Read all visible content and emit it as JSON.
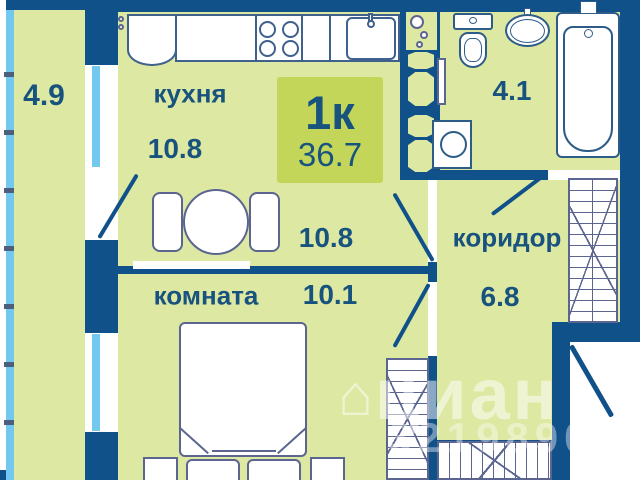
{
  "plan": {
    "badge": {
      "rooms": "1к",
      "total_area": "36.7"
    },
    "rooms": {
      "balcony": {
        "area": "4.9"
      },
      "kitchen": {
        "name": "кухня",
        "area": "10.8"
      },
      "hall": {
        "area": "10.8"
      },
      "bathroom": {
        "area": "4.1"
      },
      "corridor": {
        "name": "коридор",
        "area": "6.8"
      },
      "living_room": {
        "name": "комната",
        "area": "10.1"
      }
    },
    "watermark": {
      "house_icon": "⌂",
      "brand": "циан",
      "listing_id": "32198905"
    },
    "colors": {
      "wall": "#10518a",
      "floor": "#dde8a2",
      "badge": "#c3d65a",
      "glass": "#72c8ef",
      "text": "#17537e",
      "furniture_line": "#5b6590"
    }
  }
}
